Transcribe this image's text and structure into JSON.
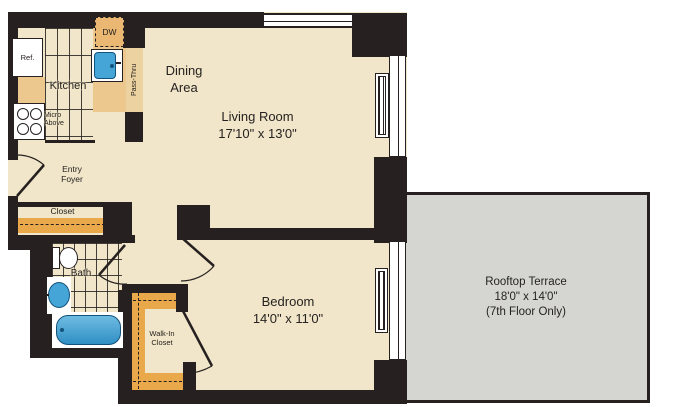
{
  "rooms": {
    "dining": {
      "line1": "Dining",
      "line2": "Area"
    },
    "living": {
      "name": "Living Room",
      "dims": "17'10\" x 13'0\""
    },
    "kitchen": {
      "name": "Kitchen"
    },
    "entry_foyer": {
      "line1": "Entry",
      "line2": "Foyer"
    },
    "closet": {
      "name": "Closet"
    },
    "bath": {
      "name": "Bath"
    },
    "walk_in_closet": {
      "line1": "Walk-In",
      "line2": "Closet"
    },
    "bedroom": {
      "name": "Bedroom",
      "dims": "14'0\" x 11'0\""
    },
    "rooftop_terrace": {
      "name": "Rooftop Terrace",
      "dims": "18'0\" x 14'0\"",
      "note": "(7th Floor Only)"
    }
  },
  "appliances": {
    "refrigerator": "Ref.",
    "dishwasher": "DW",
    "microwave_line1": "Micro",
    "microwave_line2": "Above",
    "pass_thru": "Pass-Thru"
  },
  "colors": {
    "floor": "#F1E6C9",
    "wall": "#262120",
    "terrace": "#D5D6D2",
    "counter": "#ECC88F",
    "shelf_orange": "#E9A84A",
    "fixture_blue": "#46A5D7"
  }
}
